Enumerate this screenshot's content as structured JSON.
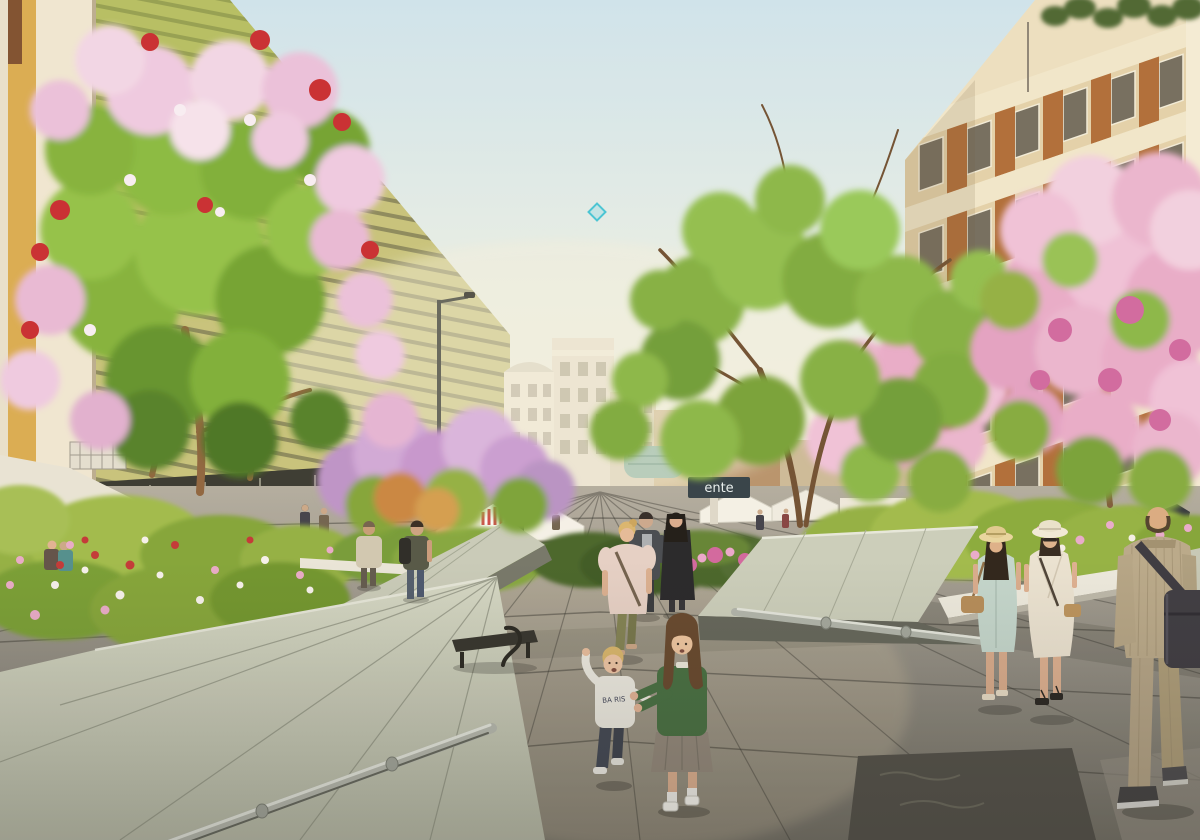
{
  "meta": {
    "type": "architectural-rendering",
    "scene": "Pedestrianized boulevard plaza with flowering trees, tilted concrete planter wedges, market tents and strolling pedestrians on granite paving",
    "dimensions": "1200x840"
  },
  "signage": {
    "storefront_sign_text": "ente",
    "toddler_hoodie_text": "BA RIS"
  },
  "watermark": {
    "name": "diamond-marker",
    "color": "#3fc3d6"
  },
  "palette": {
    "sky_top": "#cde4ee",
    "sky_haze": "#f6f2e2",
    "left_facade": "#c5c178",
    "left_facade_green": "#9eb83f",
    "facade_stripe": "#55563d",
    "ochre_wall": "#d9a94c",
    "white_pillar": "#efe7d2",
    "white_building": "#eee9d9",
    "right_building": "#ecdfc0",
    "right_panel": "#ad6832",
    "teal_glass": "#7fb0a2",
    "leaf_green": "#7fb035",
    "leaf_dark": "#4e7b22",
    "blossom_pink": "#eec9e2",
    "blossom_magenta": "#cf649e",
    "blossom_red": "#c6252a",
    "wedge_concrete": "#ccd0be",
    "wedge_shadow": "#6f7265",
    "metal_rail": "#b4b9b0",
    "pavement_light": "#a9a499",
    "pavement_dark": "#4b4a44",
    "tent_white": "#f2efe6"
  },
  "scene": {
    "buildings": [
      {
        "name": "brick-corner-building",
        "side": "far-left"
      },
      {
        "name": "green-louvered-facade-building",
        "side": "left"
      },
      {
        "name": "white-classical-buildings",
        "side": "center-distance"
      },
      {
        "name": "teal-glass-pavilion",
        "side": "center-distance"
      },
      {
        "name": "residential-block-orange-panels",
        "side": "right",
        "rooftop": "terrace plants"
      }
    ],
    "trees": [
      {
        "name": "flowering-tree-pink-red",
        "position": "left-foreground"
      },
      {
        "name": "lilac-blossom-trees",
        "position": "center-left"
      },
      {
        "name": "green-canopy-tree",
        "position": "center-right"
      },
      {
        "name": "pink-blossom-trees",
        "position": "right"
      }
    ],
    "street_furniture": [
      {
        "name": "tilted-planter-wedge",
        "position": "bottom-left",
        "rail": "steel tube"
      },
      {
        "name": "tilted-planter-wedge",
        "position": "center-left"
      },
      {
        "name": "tilted-planter-wedge",
        "position": "center-right",
        "rail": "steel tube"
      },
      {
        "name": "white-planter-edging",
        "position": "right"
      },
      {
        "name": "bench-with-curved-armrest",
        "position": "center-left"
      },
      {
        "name": "street-lamp",
        "position": "center-left"
      },
      {
        "name": "market-tents",
        "position": "center-distance"
      },
      {
        "name": "parked-scooters",
        "position": "right-distance"
      },
      {
        "name": "bollards",
        "position": "right-distance"
      }
    ],
    "people": [
      {
        "name": "woman-pink-blouse",
        "detail": "blonde, olive trousers, crossbody bag, walking toward viewer"
      },
      {
        "name": "man-dark-jacket",
        "detail": "grey shirt, walking pair"
      },
      {
        "name": "woman-long-black-coat",
        "detail": "walking pair"
      },
      {
        "name": "toddler-white-hoodie",
        "detail": "blond, dark jeans, reaching up"
      },
      {
        "name": "girl-green-sweater",
        "detail": "long brown hair, grey skirt, white socks, holding toddler's hand"
      },
      {
        "name": "woman-mint-dress",
        "detail": "straw hat, long dark hair, tan handbag"
      },
      {
        "name": "woman-cream-wrap-dress",
        "detail": "white hat, sunglasses, black sandals"
      },
      {
        "name": "man-tan-suit",
        "detail": "seen from behind, balding, dark messenger bag, dark sneakers"
      },
      {
        "name": "man-with-backpack",
        "detail": "left mid-distance"
      },
      {
        "name": "person-beige-jacket",
        "detail": "left mid-distance"
      },
      {
        "name": "couple-sitting-in-flowerbed",
        "detail": "far left"
      },
      {
        "name": "distant-crowd",
        "detail": "small figures under the trees"
      }
    ]
  }
}
